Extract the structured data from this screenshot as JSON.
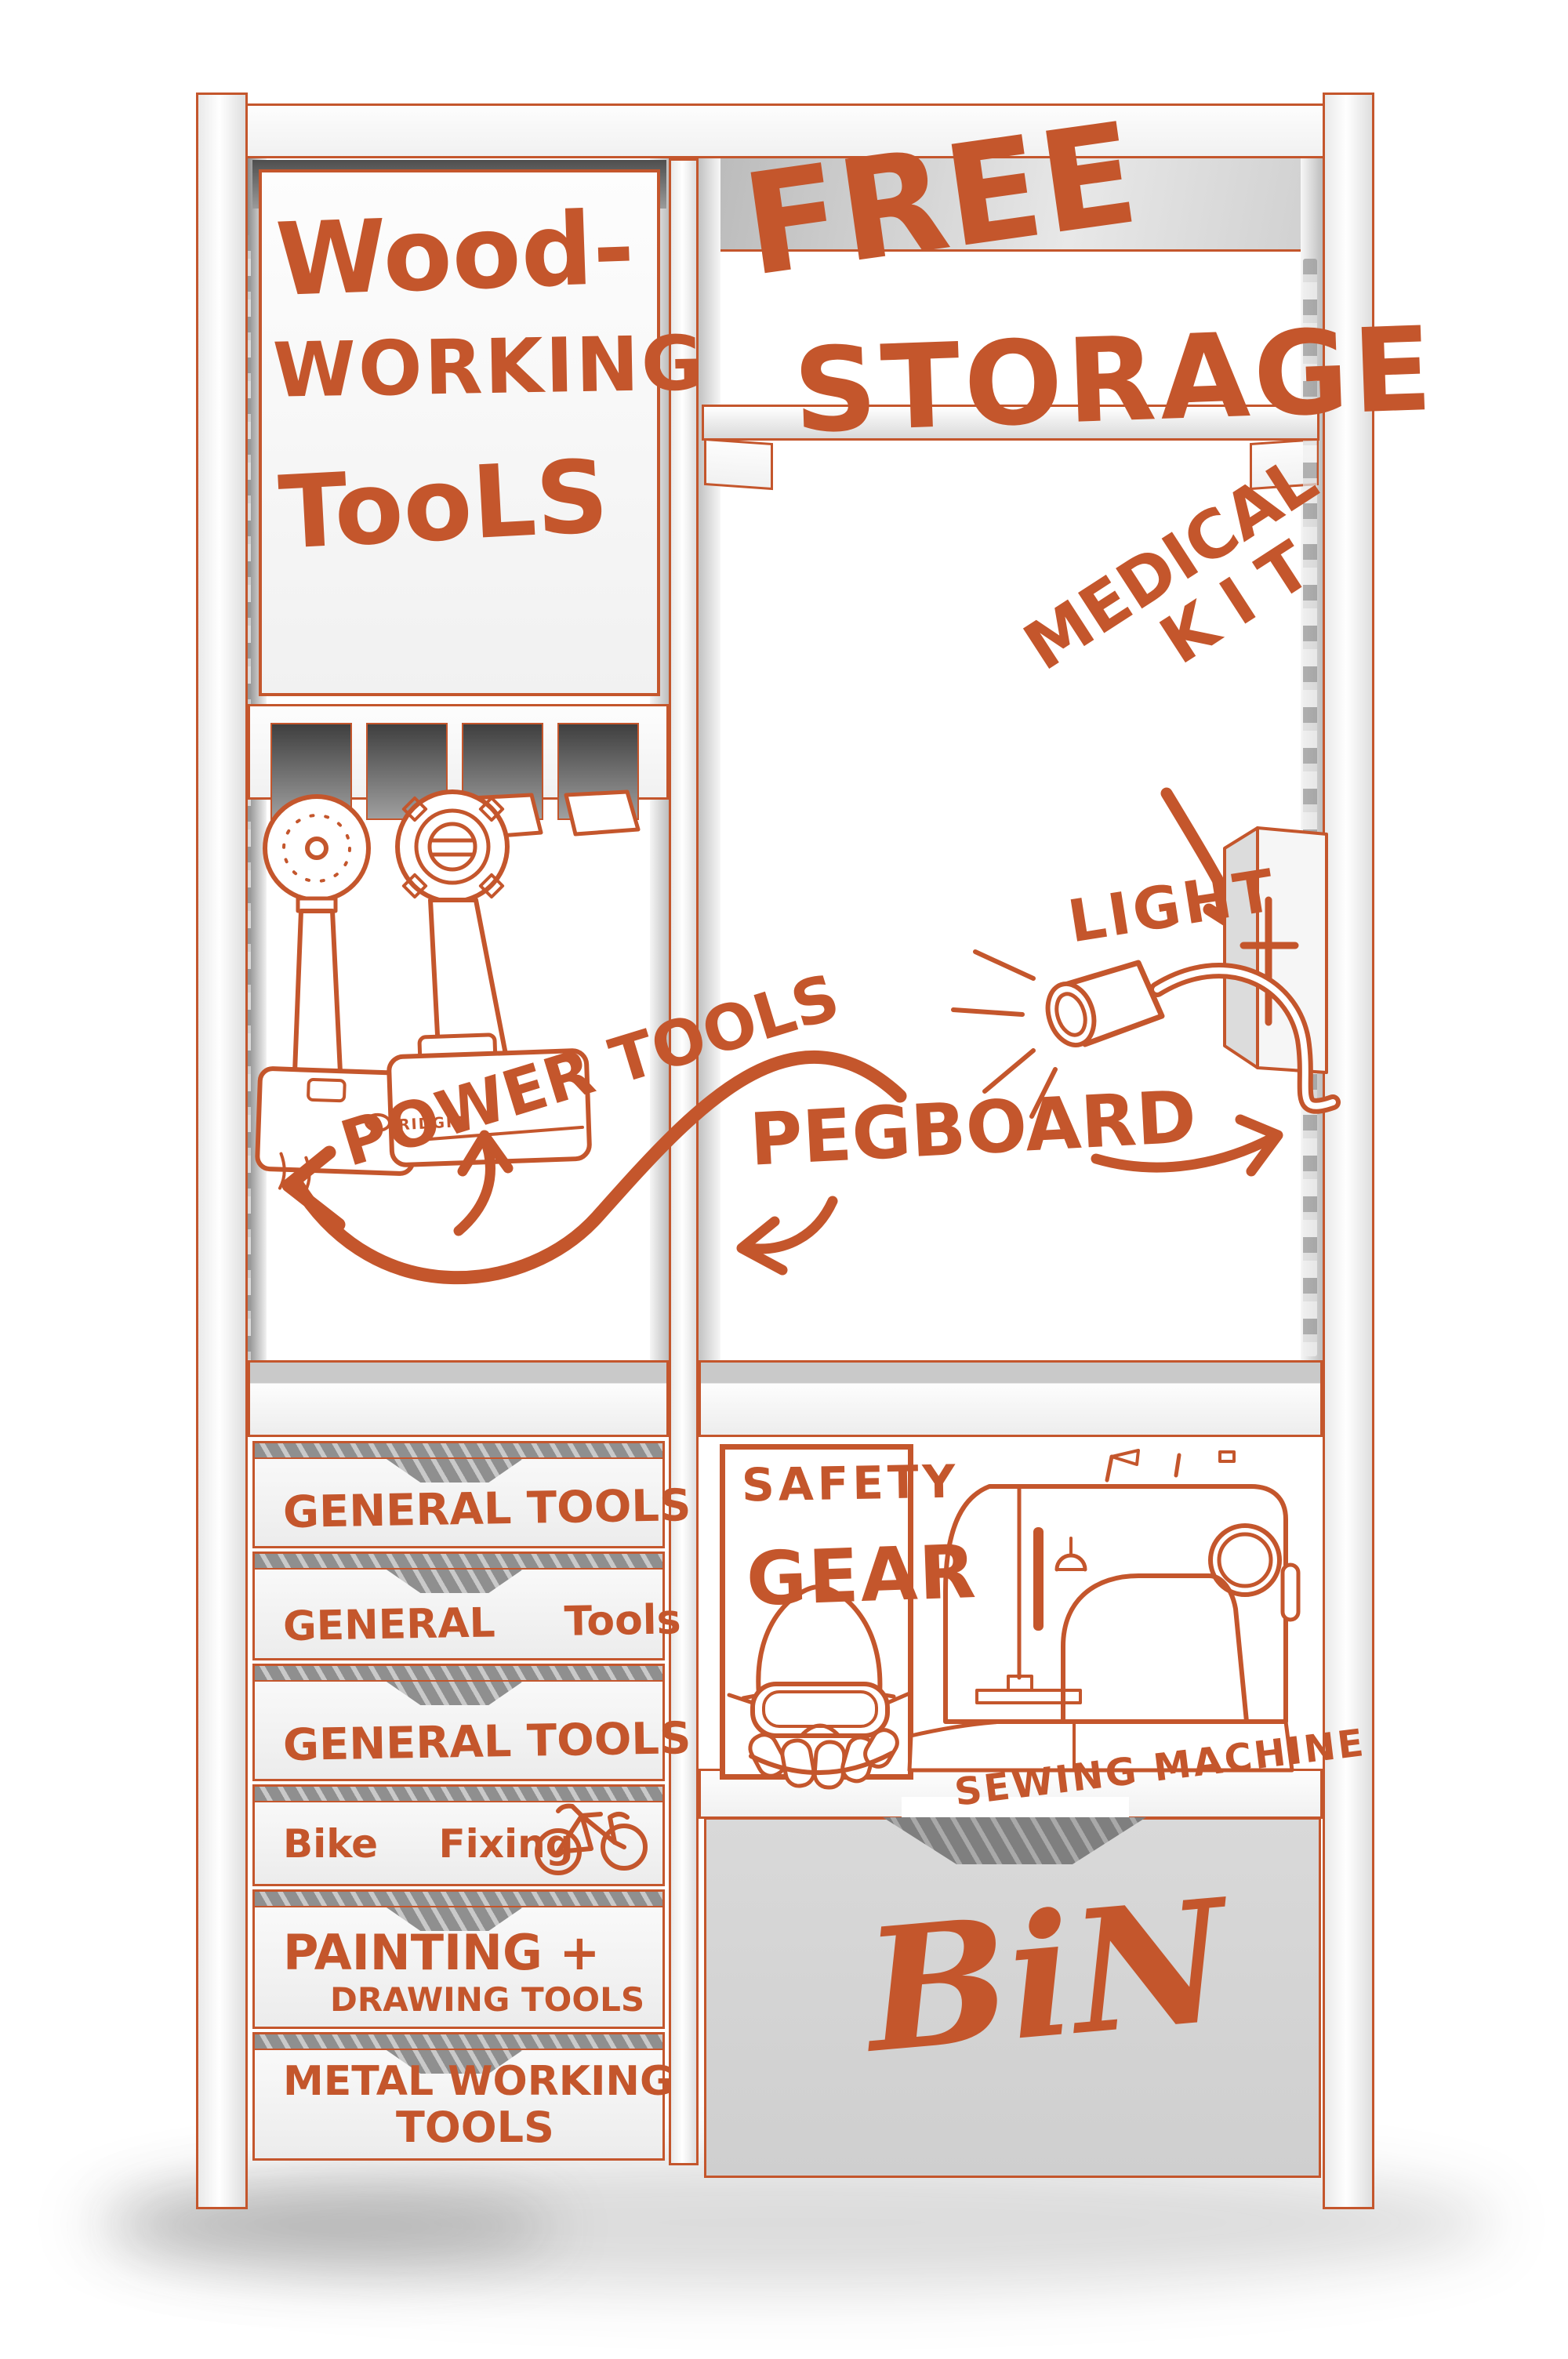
{
  "colors": {
    "accent_orange": "#c4562c",
    "panel_gray": "#d6d6d6",
    "hatch_gray": "#8f8f8f",
    "bin_gray": "#d2d2d2"
  },
  "woodworking": {
    "line1": "Wood-",
    "line2": "WORKING",
    "line3": "TooLS"
  },
  "free_storage": {
    "line1": "FREE",
    "line2": "STORAGE"
  },
  "annotations": {
    "medical_kit_line1": "MEDICAL",
    "medical_kit_line2": "KIT",
    "light": "LIGHT",
    "power_tools": "POWER TOOLS",
    "pegboard": "PEGBOARD"
  },
  "drawers": [
    {
      "label": "GENERAL TOOLS"
    },
    {
      "label": "GENERAL Tools"
    },
    {
      "label": "GENERAL TOOLS"
    },
    {
      "label": "Bike Fixing",
      "icon": "bicycle-icon"
    },
    {
      "label": "PAINTING +",
      "label2": "DRAWING TOOLS"
    },
    {
      "label": "METAL WORKING",
      "label2": "TOOLS"
    }
  ],
  "safety_gear": {
    "line1": "SAFETY",
    "line2": "GEAR"
  },
  "sewing_machine": {
    "label": "SEWING MACHINE"
  },
  "bin": {
    "label": "BiN"
  },
  "power_tool_battery_brand": "RIDGID",
  "icons": [
    "sander-icon",
    "drill-icon",
    "bicycle-icon",
    "lamp-icon",
    "medical-kit-box-icon",
    "safety-helmet-goggles-gloves-icon",
    "sewing-machine-icon"
  ]
}
